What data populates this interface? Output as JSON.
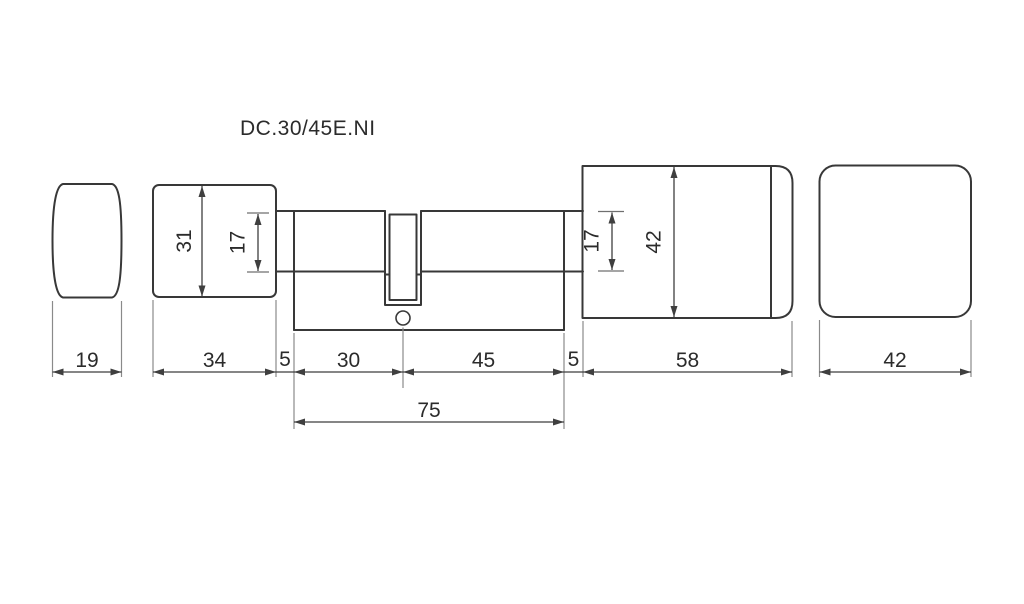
{
  "title": "DC.30/45E.NI",
  "colors": {
    "outline": "#383838",
    "dimension": "#3f3f3f",
    "extension": "#8a8a8a",
    "tick": "#6f6f6f",
    "text": "#2b2b2b",
    "background": "#ffffff"
  },
  "dims": {
    "thumbturn_depth": "19",
    "thumbturn_body_width": "34",
    "neck_left": "5",
    "inside_length": "30",
    "outside_length": "45",
    "neck_right": "5",
    "knob_length": "58",
    "knob_face_width": "42",
    "body_total": "75",
    "thumbturn_body_height": "31",
    "barrel_diameter_left": "17",
    "barrel_diameter_right": "17",
    "knob_height": "42"
  }
}
